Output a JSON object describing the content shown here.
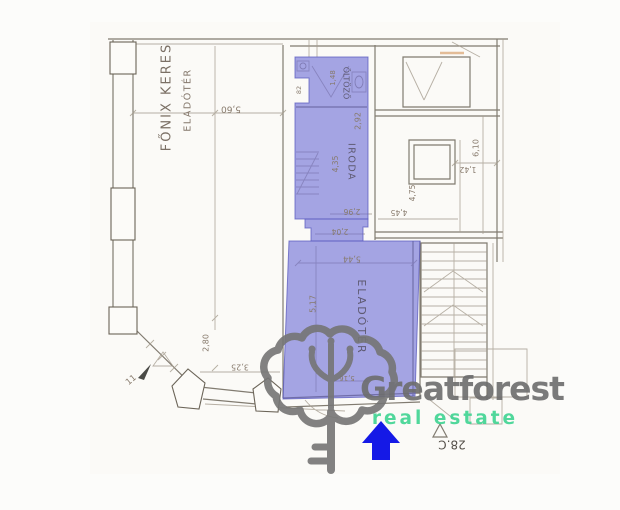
{
  "watermark": {
    "brand": "Greatforest",
    "tagline": "real estate",
    "brand_color": "#6d6d6d",
    "tagline_color": "#3ed492",
    "logo": "tree-key-icon",
    "logo_color": "#757575"
  },
  "plan": {
    "highlight_color": "#6666d4",
    "arrow_color": "#1519e6",
    "unit_label": "28.C",
    "rooms": {
      "oltozo": "ÖLTÖZŐ",
      "iroda": "IRODA",
      "eladoter": "ELADÓTÉR"
    },
    "street": {
      "line1": "FŐNIX KERES",
      "line2": "ELADÓTÉR"
    },
    "dims": {
      "d560": "5,60",
      "d148": "1,48",
      "d82": "82",
      "d292": "2,92",
      "d435": "4,35",
      "d296": "2,96",
      "d204": "2,04",
      "d544": "5,44",
      "d517": "5,17",
      "d516": "5,16",
      "d280": "2,80",
      "d325": "3,25",
      "d11": "11",
      "d610": "6,10",
      "d475": "4,75",
      "d445": "4,45",
      "d142": "1,42"
    }
  }
}
